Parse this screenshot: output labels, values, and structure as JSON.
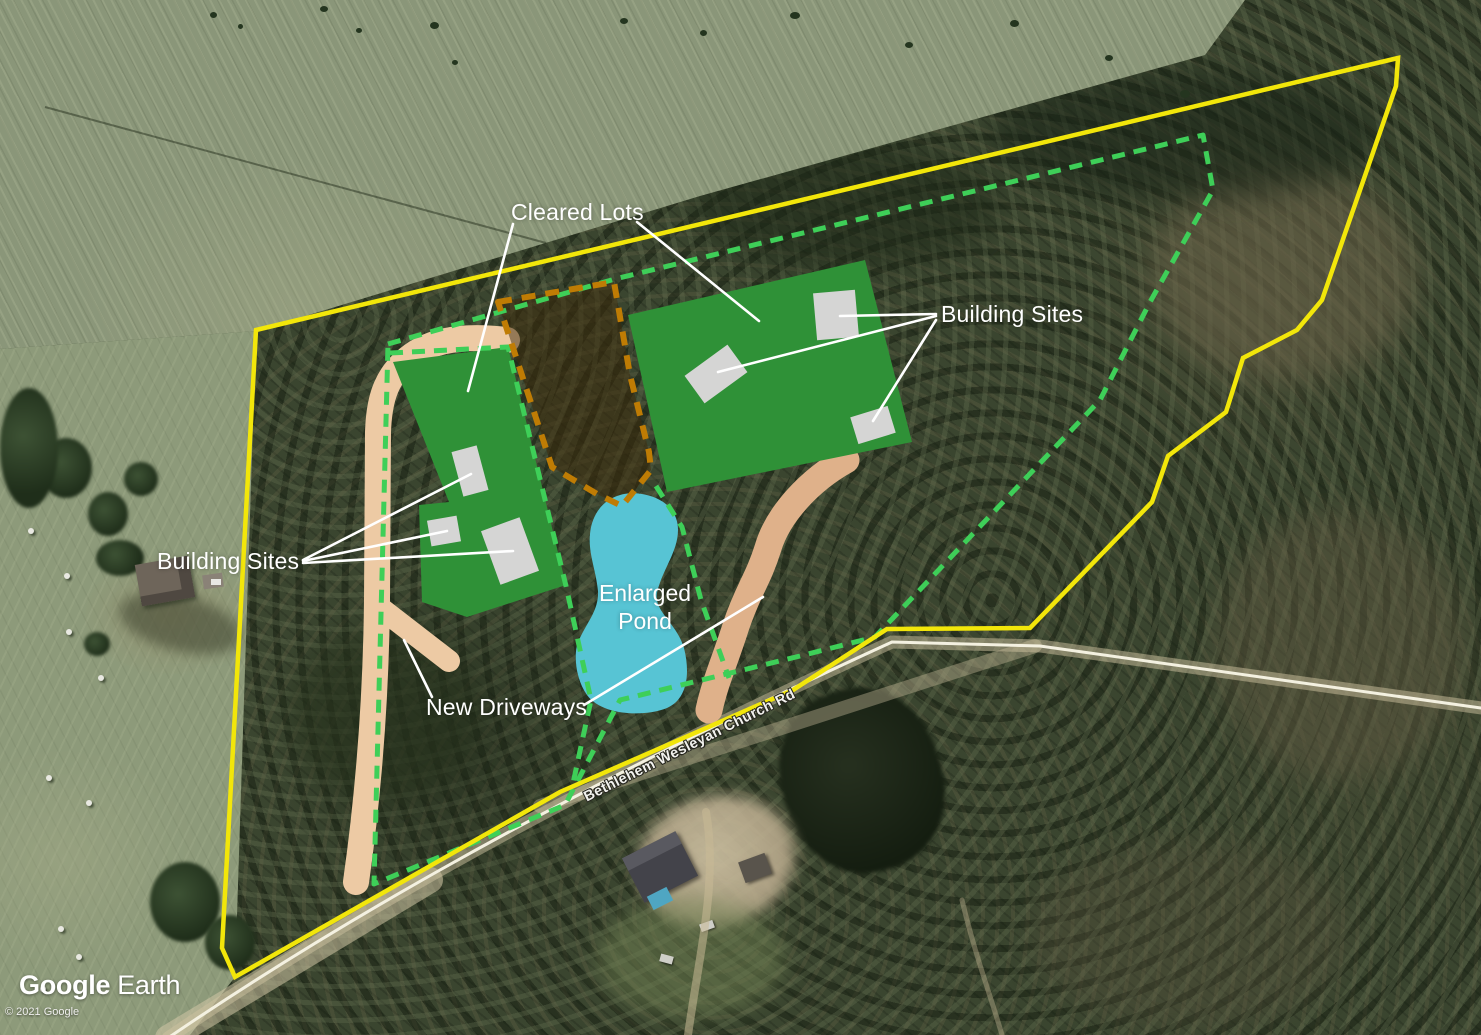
{
  "annotations": {
    "cleared_lots": "Cleared Lots",
    "building_sites_right": "Building Sites",
    "building_sites_left": "Building Sites",
    "enlarged_pond_line1": "Enlarged",
    "enlarged_pond_line2": "Pond",
    "new_driveways": "New Driveways",
    "road_name": "Bethlehem Wesleyan Church Rd"
  },
  "branding": {
    "logo_part1": "Google",
    "logo_part2": "Earth",
    "copyright": "© 2021 Google"
  },
  "colors": {
    "property_boundary_yellow": "#f2e60a",
    "lot_boundary_green": "#3ecf58",
    "wooded_lot_boundary_orange": "#bf7c04",
    "cleared_lot_fill": "#2f9137",
    "building_site_gray": "#d5d5d4",
    "pond_blue": "#57c4d4",
    "driveway_tan": "#edcaa4",
    "driveway_tan_dark": "#dfb18a",
    "leader_line_white": "#ffffff"
  }
}
